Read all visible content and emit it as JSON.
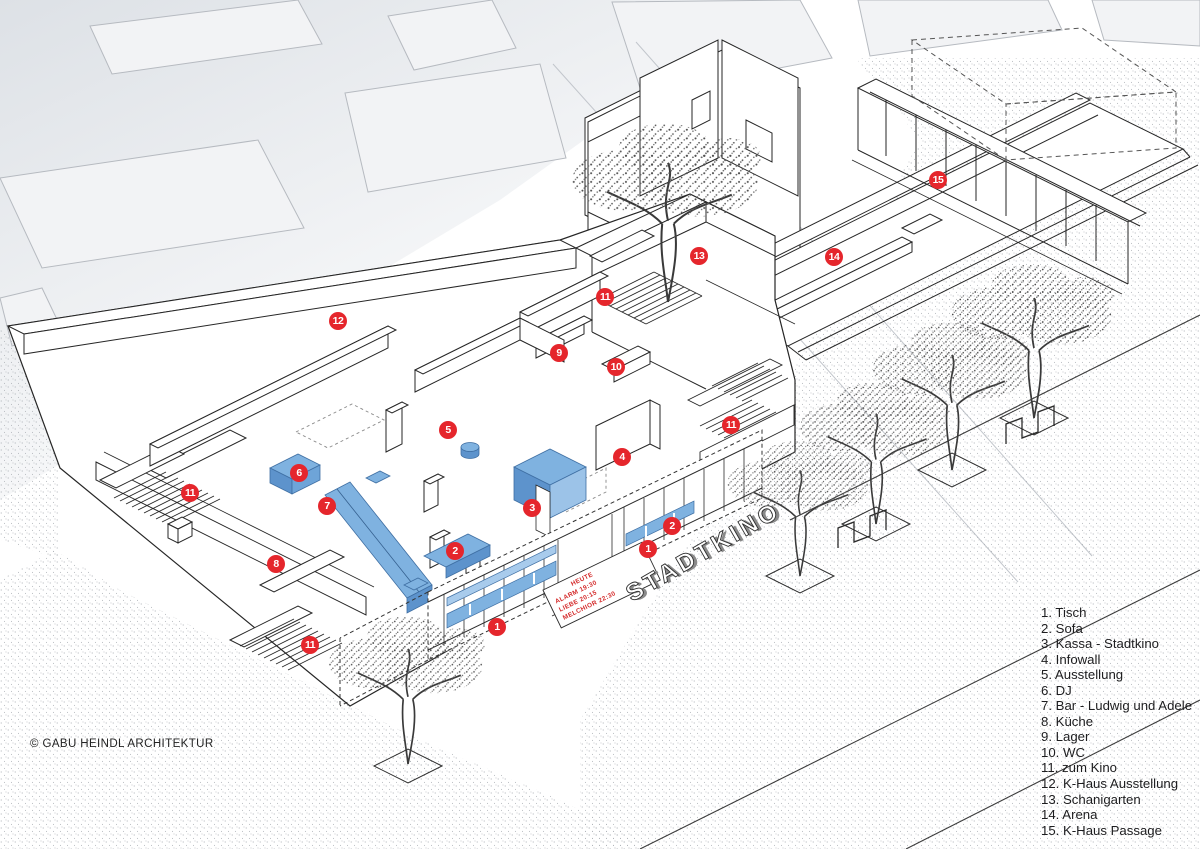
{
  "title": "Stadtkino — ground floor axonometric",
  "colors": {
    "marker_red": "#e5262c",
    "furniture_blue": "#7fb2e0",
    "furniture_blue_dark": "#5d93cc",
    "furniture_blue_light": "#a8cbec",
    "line": "#262626",
    "context_gray": "#b6bac0"
  },
  "building": {
    "sign": "STADTKINO",
    "program_board": [
      "HEUTE",
      "ALARM   19:30",
      "LIEBE   20:15",
      "MELCHIOR  22:30"
    ]
  },
  "legend": {
    "items": [
      "1. Tisch",
      "2. Sofa",
      "3. Kassa - Stadtkino",
      "4. Infowall",
      "5. Ausstellung",
      "6. DJ",
      "7. Bar - Ludwig und Adele",
      "8. Küche",
      "9. Lager",
      "10. WC",
      "11. zum Kino",
      "12. K-Haus Ausstellung",
      "13. Schanigarten",
      "14. Arena",
      "15. K-Haus Passage"
    ]
  },
  "markers": [
    {
      "number": "12",
      "label": "k-haus-ausstellung",
      "x": 338,
      "y": 321
    },
    {
      "number": "13",
      "label": "schanigarten",
      "x": 699,
      "y": 256
    },
    {
      "number": "14",
      "label": "arena",
      "x": 834,
      "y": 257
    },
    {
      "number": "15",
      "label": "k-haus-passage",
      "x": 938,
      "y": 180
    },
    {
      "number": "11",
      "label": "zum-kino",
      "x": 605,
      "y": 297
    },
    {
      "number": "9",
      "label": "lager",
      "x": 559,
      "y": 353
    },
    {
      "number": "10",
      "label": "wc",
      "x": 616,
      "y": 367
    },
    {
      "number": "11",
      "label": "zum-kino",
      "x": 731,
      "y": 425
    },
    {
      "number": "5",
      "label": "ausstellung",
      "x": 448,
      "y": 430
    },
    {
      "number": "4",
      "label": "infowall",
      "x": 622,
      "y": 457
    },
    {
      "number": "6",
      "label": "dj",
      "x": 299,
      "y": 473
    },
    {
      "number": "7",
      "label": "bar-ludwig-und-adele",
      "x": 327,
      "y": 506
    },
    {
      "number": "3",
      "label": "kassa-stadtkino",
      "x": 532,
      "y": 508
    },
    {
      "number": "11",
      "label": "zum-kino",
      "x": 190,
      "y": 493
    },
    {
      "number": "2",
      "label": "sofa",
      "x": 455,
      "y": 551
    },
    {
      "number": "2",
      "label": "sofa",
      "x": 672,
      "y": 526
    },
    {
      "number": "1",
      "label": "tisch",
      "x": 648,
      "y": 549
    },
    {
      "number": "8",
      "label": "kueche",
      "x": 276,
      "y": 564
    },
    {
      "number": "1",
      "label": "tisch",
      "x": 497,
      "y": 627
    },
    {
      "number": "11",
      "label": "zum-kino",
      "x": 310,
      "y": 645
    }
  ],
  "footer": {
    "copyright": "© GABU HEINDL ARCHITEKTUR"
  }
}
